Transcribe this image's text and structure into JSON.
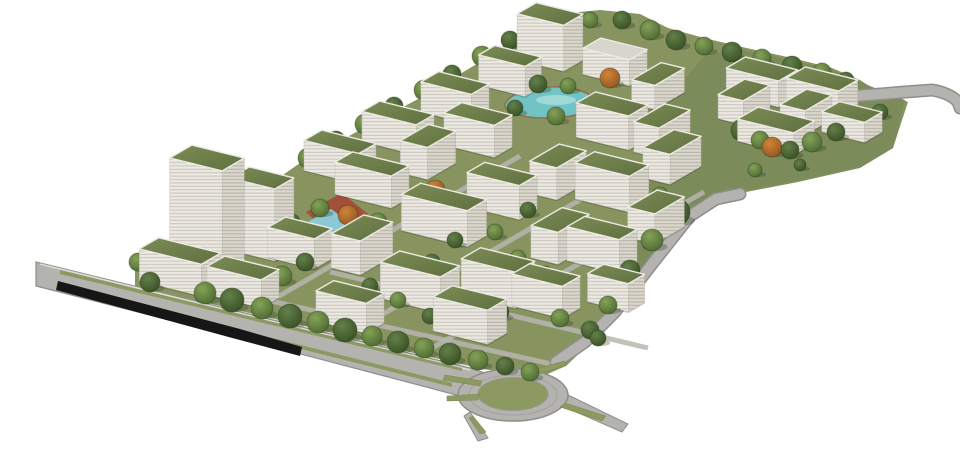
{
  "meta": {
    "description": "Aerial perspective rendering of a campus masterplan: white slab buildings with green roofs, one high-rise tower, tree hedges, a turquoise pond, a pool with red track, a boulevard with underpass, a perimeter road, and a roundabout on white background"
  },
  "scene": {
    "width": 960,
    "height": 461,
    "palette": {
      "background": "#ffffff",
      "ground_light": "#87945f",
      "ground_dark": "#7b8a5a",
      "roof_green_hi": "#7c8c55",
      "roof_green_lo": "#5f7041",
      "roof_white": "#d8d5cc",
      "facade_front": "#ece9e2",
      "facade_front_line": "#c6c3ba",
      "facade_side": "#dbd7cd",
      "facade_side_line": "#b2afa5",
      "road": "#b4b3af",
      "road_edge": "#8f8e8a",
      "road_lane": "#a3a29e",
      "median_green": "#8c9a62",
      "median_edge": "#77854f",
      "trench_dark": "#161616",
      "pond_water": "#72c3c3",
      "pond_highlight": "#a9dedd",
      "pond_rim": "#9a6a4a",
      "pool_water": "#8cc8d4",
      "track_red": "#a34c38",
      "tree_dark": "#3c5526",
      "tree_mid": "#4b6630",
      "tree_orange": "#8a4f1d",
      "parapet": "#eceae3",
      "curb_light": "#e9e8e4",
      "shadow": "rgba(45,55,35,0.30)"
    },
    "axes": {
      "e1": [
        0.97,
        0.24
      ],
      "e2": [
        0.74,
        -0.43
      ]
    },
    "ground": {
      "site_outline": [
        [
          135,
          268
        ],
        [
          190,
          240
        ],
        [
          240,
          205
        ],
        [
          300,
          163
        ],
        [
          360,
          130
        ],
        [
          420,
          98
        ],
        [
          480,
          62
        ],
        [
          530,
          28
        ],
        [
          558,
          14
        ],
        [
          600,
          10
        ],
        [
          640,
          14
        ],
        [
          668,
          28
        ],
        [
          704,
          38
        ],
        [
          742,
          47
        ],
        [
          792,
          58
        ],
        [
          832,
          68
        ],
        [
          860,
          80
        ],
        [
          872,
          88
        ],
        [
          908,
          102
        ],
        [
          893,
          148
        ],
        [
          862,
          166
        ],
        [
          800,
          180
        ],
        [
          738,
          192
        ],
        [
          704,
          210
        ],
        [
          664,
          253
        ],
        [
          622,
          305
        ],
        [
          588,
          345
        ],
        [
          566,
          366
        ],
        [
          552,
          372
        ],
        [
          540,
          378
        ],
        [
          500,
          372
        ],
        [
          460,
          364
        ],
        [
          380,
          345
        ],
        [
          300,
          325
        ],
        [
          220,
          306
        ],
        [
          150,
          290
        ],
        [
          135,
          286
        ]
      ],
      "lawn_overlay": [
        [
          668,
          100
        ],
        [
          705,
          55
        ],
        [
          742,
          50
        ],
        [
          790,
          60
        ],
        [
          832,
          70
        ],
        [
          860,
          82
        ],
        [
          905,
          100
        ],
        [
          893,
          148
        ],
        [
          860,
          168
        ],
        [
          798,
          182
        ],
        [
          736,
          194
        ],
        [
          700,
          212
        ],
        [
          664,
          254
        ],
        [
          632,
          292
        ],
        [
          638,
          240
        ],
        [
          650,
          180
        ],
        [
          660,
          135
        ]
      ],
      "paths": [
        [
          [
            160,
            276
          ],
          [
            560,
            366
          ]
        ],
        [
          [
            352,
            332
          ],
          [
            628,
            172
          ]
        ],
        [
          [
            432,
            348
          ],
          [
            704,
            192
          ]
        ],
        [
          [
            262,
            306
          ],
          [
            520,
            156
          ]
        ],
        [
          [
            330,
            272
          ],
          [
            648,
            348
          ]
        ]
      ]
    },
    "roads": {
      "boulevard": [
        [
          36,
          262
        ],
        [
          470,
          368
        ],
        [
          500,
          378
        ],
        [
          496,
          404
        ],
        [
          468,
          398
        ],
        [
          240,
          338
        ],
        [
          36,
          286
        ]
      ],
      "curb_line": [
        [
          40,
          264
        ],
        [
          470,
          370
        ]
      ],
      "trench": [
        [
          58,
          281
        ],
        [
          240,
          329
        ],
        [
          302,
          347
        ],
        [
          300,
          356
        ],
        [
          236,
          339
        ],
        [
          56,
          290
        ]
      ],
      "medians": [
        [
          [
            60,
            270
          ],
          [
            462,
            368
          ],
          [
            462,
            371
          ],
          [
            60,
            274
          ]
        ],
        [
          [
            130,
            302
          ],
          [
            452,
            383
          ],
          [
            452,
            387
          ],
          [
            130,
            306
          ]
        ]
      ],
      "roundabout": {
        "cx": 513,
        "cy": 395,
        "rx_outer": 55,
        "ry_outer": 26,
        "rx_lane": 44,
        "ry_lane": 20,
        "rx_island": 35,
        "ry_island": 16.5
      },
      "islands": [
        [
          [
            445,
            375
          ],
          [
            482,
            381
          ],
          [
            480,
            386
          ],
          [
            443,
            380
          ]
        ],
        [
          [
            447,
            396
          ],
          [
            480,
            394
          ],
          [
            478,
            400
          ],
          [
            447,
            401
          ]
        ],
        [
          [
            473,
            416
          ],
          [
            486,
            432
          ],
          [
            480,
            434
          ],
          [
            469,
            418
          ]
        ],
        [
          [
            565,
            403
          ],
          [
            606,
            416
          ],
          [
            602,
            421
          ],
          [
            560,
            407
          ]
        ],
        [
          [
            536,
            369
          ],
          [
            564,
            361
          ],
          [
            567,
            365
          ],
          [
            540,
            374
          ]
        ]
      ],
      "stubs": [
        [
          [
            566,
            394
          ],
          [
            628,
            424
          ],
          [
            622,
            432
          ],
          [
            558,
            404
          ]
        ],
        [
          [
            470,
            412
          ],
          [
            488,
            438
          ],
          [
            478,
            441
          ],
          [
            464,
            416
          ]
        ]
      ],
      "ne_road": "M556 362 L585 342 L615 312 L652 264 L690 216 L716 199 L740 194",
      "top_right_road": "M856 96 L905 92 L932 90 Q950 93 958 102 L960 108"
    },
    "water": {
      "pond_path": "M508 100 C518 88 552 83 578 90 C596 95 600 105 586 112 C560 121 524 119 511 112 C504 108 503 105 508 100 Z",
      "pond_highlight": {
        "cx": 556,
        "cy": 100,
        "rx": 20,
        "ry": 5
      },
      "track_quad": [
        [
          306,
          212
        ],
        [
          342,
          193
        ],
        [
          368,
          214
        ],
        [
          331,
          236
        ]
      ],
      "pool_quad": [
        [
          309,
          221
        ],
        [
          331,
          209
        ],
        [
          354,
          226
        ],
        [
          331,
          240
        ]
      ]
    },
    "building_fields": [
      "ground_cx",
      "ground_cy",
      "length_e1",
      "depth_e2",
      "height",
      "roof"
    ],
    "buildings": [
      [
        207,
        263,
        54,
        30,
        105,
        "g"
      ],
      [
        262,
        250,
        46,
        26,
        72,
        "g"
      ],
      [
        180,
        283,
        64,
        26,
        32,
        "g"
      ],
      [
        243,
        296,
        56,
        24,
        28,
        "g"
      ],
      [
        300,
        258,
        48,
        24,
        30,
        "g"
      ],
      [
        340,
        172,
        56,
        24,
        30,
        "g"
      ],
      [
        398,
        143,
        56,
        24,
        30,
        "g"
      ],
      [
        455,
        113,
        52,
        24,
        30,
        "g"
      ],
      [
        510,
        86,
        48,
        22,
        30,
        "g"
      ],
      [
        550,
        60,
        48,
        26,
        46,
        "g"
      ],
      [
        615,
        75,
        48,
        24,
        26,
        "w"
      ],
      [
        658,
        98,
        24,
        40,
        24,
        "g"
      ],
      [
        372,
        196,
        58,
        24,
        32,
        "g"
      ],
      [
        428,
        168,
        28,
        38,
        32,
        "g"
      ],
      [
        478,
        146,
        52,
        24,
        32,
        "g"
      ],
      [
        612,
        138,
        54,
        26,
        34,
        "g"
      ],
      [
        662,
        146,
        26,
        42,
        30,
        "g"
      ],
      [
        444,
        233,
        68,
        26,
        36,
        "g"
      ],
      [
        362,
        262,
        30,
        44,
        34,
        "g"
      ],
      [
        502,
        208,
        54,
        24,
        34,
        "g"
      ],
      [
        558,
        188,
        28,
        40,
        32,
        "g"
      ],
      [
        612,
        200,
        56,
        26,
        36,
        "g"
      ],
      [
        672,
        172,
        28,
        42,
        30,
        "g"
      ],
      [
        420,
        300,
        62,
        26,
        36,
        "g"
      ],
      [
        498,
        296,
        56,
        26,
        36,
        "g"
      ],
      [
        560,
        252,
        28,
        42,
        32,
        "g"
      ],
      [
        602,
        262,
        54,
        24,
        34,
        "g"
      ],
      [
        656,
        232,
        28,
        40,
        30,
        "g"
      ],
      [
        350,
        322,
        52,
        24,
        30,
        "g"
      ],
      [
        470,
        332,
        56,
        26,
        34,
        "g"
      ],
      [
        546,
        307,
        52,
        24,
        32,
        "g"
      ],
      [
        616,
        302,
        42,
        22,
        28,
        "g"
      ],
      [
        762,
        95,
        54,
        26,
        26,
        "g"
      ],
      [
        744,
        114,
        26,
        36,
        24,
        "g"
      ],
      [
        822,
        105,
        54,
        26,
        26,
        "g"
      ],
      [
        806,
        124,
        26,
        36,
        24,
        "g"
      ],
      [
        776,
        142,
        58,
        28,
        22,
        "g"
      ],
      [
        852,
        132,
        44,
        24,
        20,
        "g"
      ]
    ],
    "tree_fields": [
      "x",
      "y",
      "r",
      "kind"
    ],
    "trees": [
      [
        150,
        282,
        10,
        "d"
      ],
      [
        180,
        268,
        11,
        "o"
      ],
      [
        205,
        293,
        11,
        "m"
      ],
      [
        232,
        300,
        12,
        "d"
      ],
      [
        262,
        308,
        11,
        "m"
      ],
      [
        290,
        316,
        12,
        "d"
      ],
      [
        318,
        322,
        11,
        "m"
      ],
      [
        345,
        330,
        12,
        "d"
      ],
      [
        372,
        336,
        10,
        "m"
      ],
      [
        398,
        342,
        11,
        "d"
      ],
      [
        424,
        348,
        10,
        "m"
      ],
      [
        450,
        354,
        11,
        "d"
      ],
      [
        478,
        360,
        10,
        "m"
      ],
      [
        505,
        366,
        9,
        "d"
      ],
      [
        530,
        372,
        9,
        "m"
      ],
      [
        308,
        158,
        10,
        "m"
      ],
      [
        336,
        140,
        9,
        "d"
      ],
      [
        365,
        124,
        10,
        "m"
      ],
      [
        394,
        106,
        9,
        "d"
      ],
      [
        424,
        90,
        10,
        "m"
      ],
      [
        452,
        74,
        9,
        "d"
      ],
      [
        482,
        56,
        10,
        "m"
      ],
      [
        510,
        40,
        9,
        "d"
      ],
      [
        532,
        26,
        9,
        "m"
      ],
      [
        560,
        18,
        8,
        "d"
      ],
      [
        590,
        20,
        8,
        "m"
      ],
      [
        622,
        20,
        9,
        "d"
      ],
      [
        650,
        30,
        10,
        "m"
      ],
      [
        676,
        40,
        10,
        "d"
      ],
      [
        704,
        46,
        9,
        "m"
      ],
      [
        732,
        52,
        10,
        "d"
      ],
      [
        762,
        58,
        9,
        "m"
      ],
      [
        792,
        66,
        10,
        "d"
      ],
      [
        822,
        72,
        9,
        "m"
      ],
      [
        846,
        80,
        8,
        "d"
      ],
      [
        742,
        130,
        11,
        "d"
      ],
      [
        760,
        140,
        9,
        "m"
      ],
      [
        772,
        147,
        10,
        "o"
      ],
      [
        790,
        150,
        9,
        "d"
      ],
      [
        812,
        142,
        10,
        "m"
      ],
      [
        836,
        132,
        9,
        "d"
      ],
      [
        858,
        122,
        9,
        "m"
      ],
      [
        880,
        112,
        8,
        "d"
      ],
      [
        755,
        170,
        7,
        "m"
      ],
      [
        800,
        165,
        6,
        "d"
      ],
      [
        676,
        212,
        14,
        "d"
      ],
      [
        652,
        240,
        11,
        "m"
      ],
      [
        630,
        270,
        10,
        "d"
      ],
      [
        608,
        305,
        9,
        "m"
      ],
      [
        590,
        330,
        9,
        "d"
      ],
      [
        538,
        84,
        9,
        "d"
      ],
      [
        568,
        86,
        8,
        "m"
      ],
      [
        515,
        108,
        8,
        "d"
      ],
      [
        556,
        116,
        9,
        "m"
      ],
      [
        592,
        108,
        8,
        "d"
      ],
      [
        610,
        78,
        10,
        "o"
      ],
      [
        138,
        262,
        9,
        "m"
      ],
      [
        158,
        252,
        8,
        "d"
      ],
      [
        250,
        282,
        11,
        "d"
      ],
      [
        282,
        276,
        10,
        "m"
      ],
      [
        305,
        262,
        9,
        "d"
      ],
      [
        330,
        246,
        9,
        "m"
      ],
      [
        352,
        236,
        8,
        "d"
      ],
      [
        348,
        215,
        10,
        "o"
      ],
      [
        320,
        208,
        9,
        "m"
      ],
      [
        292,
        222,
        8,
        "d"
      ],
      [
        435,
        190,
        10,
        "o"
      ],
      [
        410,
        206,
        8,
        "d"
      ],
      [
        378,
        222,
        9,
        "m"
      ],
      [
        455,
        240,
        8,
        "d"
      ],
      [
        495,
        232,
        8,
        "m"
      ],
      [
        528,
        210,
        8,
        "d"
      ],
      [
        560,
        226,
        8,
        "m"
      ],
      [
        588,
        238,
        8,
        "d"
      ],
      [
        470,
        272,
        9,
        "m"
      ],
      [
        432,
        262,
        8,
        "d"
      ],
      [
        518,
        258,
        8,
        "m"
      ],
      [
        545,
        274,
        8,
        "d"
      ],
      [
        612,
        255,
        8,
        "m"
      ],
      [
        640,
        225,
        8,
        "d"
      ],
      [
        660,
        195,
        8,
        "m"
      ],
      [
        537,
        300,
        10,
        "o"
      ],
      [
        500,
        312,
        9,
        "d"
      ],
      [
        466,
        300,
        8,
        "m"
      ],
      [
        430,
        316,
        8,
        "d"
      ],
      [
        398,
        300,
        8,
        "m"
      ],
      [
        370,
        286,
        8,
        "d"
      ],
      [
        560,
        318,
        9,
        "m"
      ],
      [
        598,
        338,
        8,
        "d"
      ]
    ]
  }
}
